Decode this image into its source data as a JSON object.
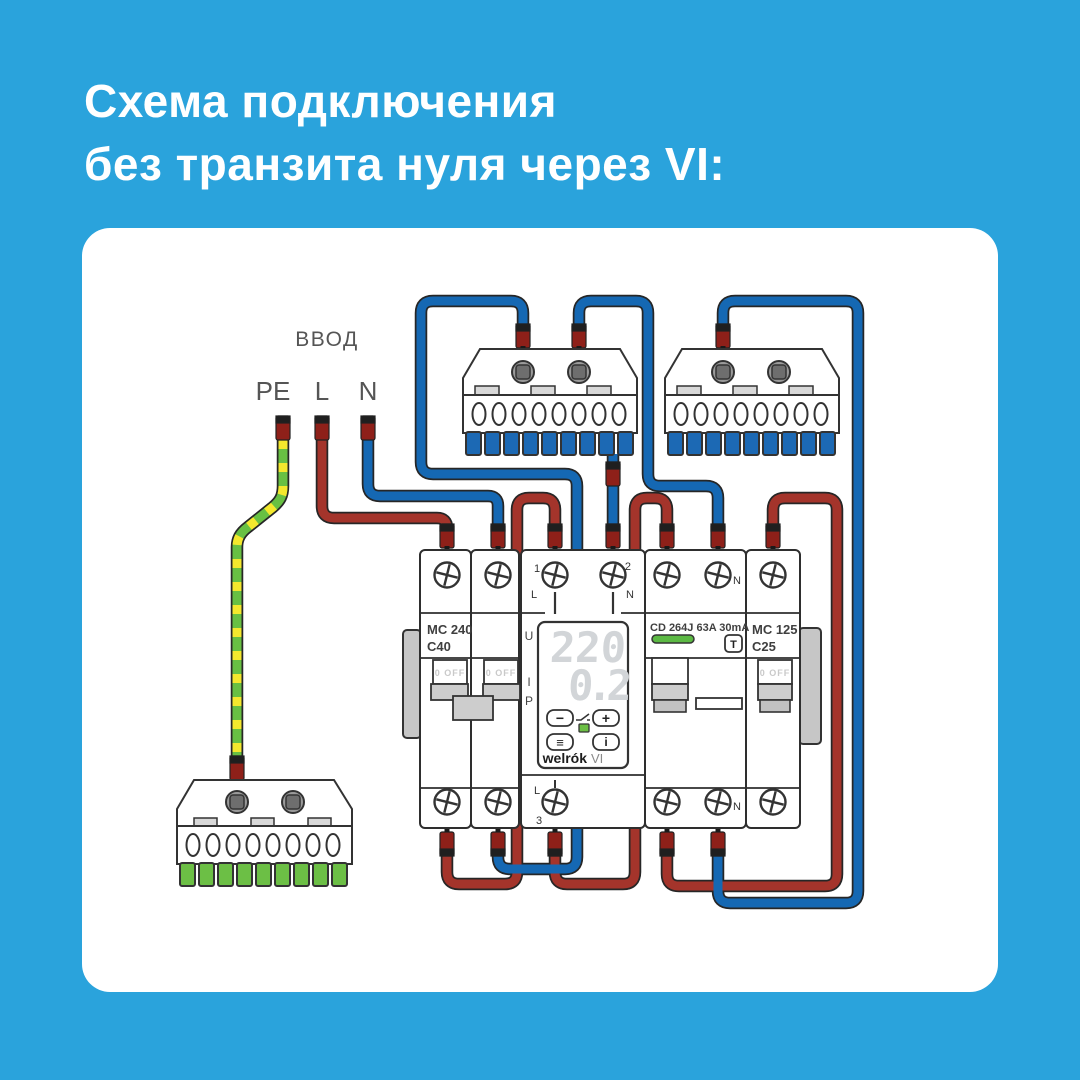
{
  "title": {
    "line1": "Схема подключения",
    "line2": "без транзита нуля через VI:"
  },
  "input": {
    "label": "ВВОД",
    "pe": "PE",
    "l": "L",
    "n": "N"
  },
  "devices": {
    "mc240": {
      "name": "MC 240",
      "rating": "C40",
      "switch_state": "0 OFF"
    },
    "vi": {
      "terminal1": "1",
      "terminal1_line": "L",
      "terminal2": "2",
      "terminal2_line": "N",
      "terminal3": "3",
      "terminal3_line": "L",
      "u_label": "U",
      "i_label": "I",
      "p_label": "P",
      "voltage": "220",
      "current": "0.2",
      "btn_minus": "−",
      "btn_plus": "+",
      "btn_menu": "≡",
      "btn_info": "i",
      "brand": "welrók",
      "model": "VI"
    },
    "cd": {
      "name": "CD 264J 63A 30mA",
      "test_button": "T",
      "n_label": "N"
    },
    "mc125": {
      "name": "MC 125",
      "rating": "C25",
      "switch_state": "0 OFF"
    }
  },
  "colors": {
    "background": "#2aa3dc",
    "wire_red": "#a4342b",
    "wire_blue": "#1568b3",
    "wire_green": "#68c043",
    "wire_yellow": "#f4e82d",
    "ferrule": "#8e2019",
    "indicator_green": "#5cb944"
  }
}
